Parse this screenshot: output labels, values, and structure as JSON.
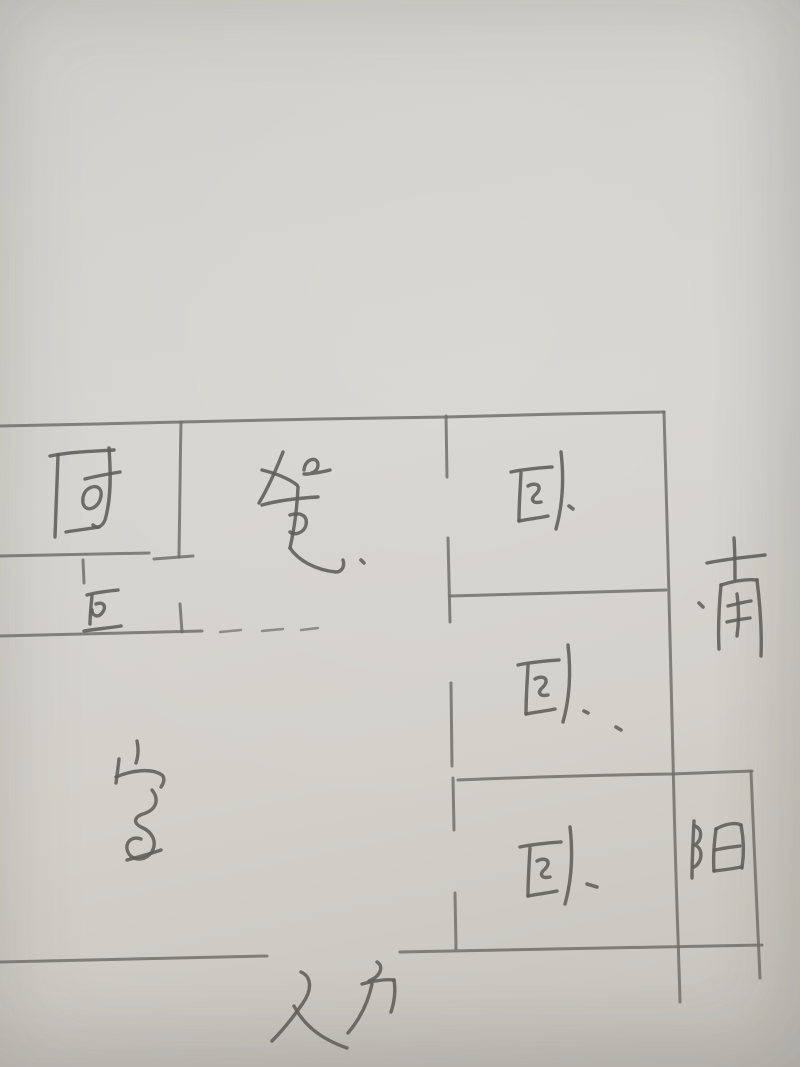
{
  "photo": {
    "description": "hand-drawn apartment floor plan sketch, pencil on paper"
  },
  "palette": {
    "paper": "#d2d0cb",
    "pencil": "#6e6c67",
    "pencil_dark": "#5f5d58"
  },
  "orientation_marker": {
    "label": "南",
    "meaning": "south",
    "position": "outside right wall"
  },
  "rooms": [
    {
      "label": "厨",
      "meaning": "kitchen",
      "position": "top-left"
    },
    {
      "label": "餐",
      "meaning": "dining",
      "position": "top-center"
    },
    {
      "label": "卫",
      "meaning": "bathroom",
      "position": "left, below kitchen"
    },
    {
      "label": "室",
      "meaning": "main room",
      "position": "bottom-left"
    },
    {
      "label": "卧",
      "meaning": "bedroom",
      "position": "right, top"
    },
    {
      "label": "卧",
      "meaning": "bedroom",
      "position": "right, middle"
    },
    {
      "label": "卧",
      "meaning": "bedroom",
      "position": "right, bottom"
    },
    {
      "label": "阳",
      "meaning": "balcony",
      "position": "bottom-right corner"
    }
  ],
  "entrance": {
    "label": "入户",
    "meaning": "entry door",
    "position": "opening in bottom wall"
  },
  "features": {
    "door_dashes": "dashed opening in wall right of bathroom",
    "wall_gaps": "door openings on bedroom corridor wall and bottom entrance"
  }
}
